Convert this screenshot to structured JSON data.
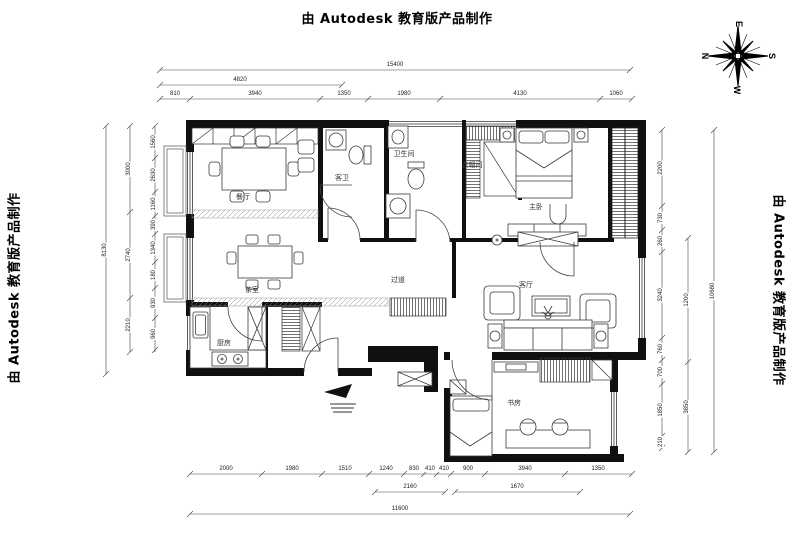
{
  "watermarks": {
    "top": "由 Autodesk 教育版产品制作",
    "left": "由 Autodesk 教育版产品制作",
    "right": "由 Autodesk 教育版产品制作"
  },
  "compass": {
    "top": "E",
    "right": "S",
    "bottom": "W",
    "left": "N"
  },
  "rooms": {
    "dining": "餐厅",
    "tea": "茶室",
    "kitchen": "厨房",
    "hall": "过道",
    "living": "客厅",
    "master": "主卧",
    "cloak": "衣帽间",
    "bath": "卫生间",
    "bath2": "客卫",
    "study": "书房"
  },
  "dims": {
    "top_total": "15400",
    "top_sub": "4820",
    "top_segments": [
      "810",
      "3940",
      "1350",
      "1980",
      "4130",
      "1060"
    ],
    "bottom_segments": [
      "2000",
      "1980",
      "1510",
      "1240",
      "830",
      "410",
      "410",
      "900",
      "3940",
      "1350"
    ],
    "bottom_mid": [
      "2160",
      "1670"
    ],
    "bottom_total": "11600",
    "left_segments": [
      "1560",
      "2630",
      "1160",
      "390",
      "1340",
      "180",
      "930",
      "960"
    ],
    "left_mid": [
      "3000",
      "2740",
      "2210"
    ],
    "left_total": "8130",
    "right_segments": [
      "2200",
      "730",
      "260",
      "3240",
      "760",
      "700",
      "1850",
      "210"
    ],
    "right_mid": [
      "1200",
      "3850"
    ],
    "right_total": "10680"
  },
  "colors": {
    "wall": "#101010",
    "furniture": "#3a3a3a",
    "dimline": "#444444"
  }
}
